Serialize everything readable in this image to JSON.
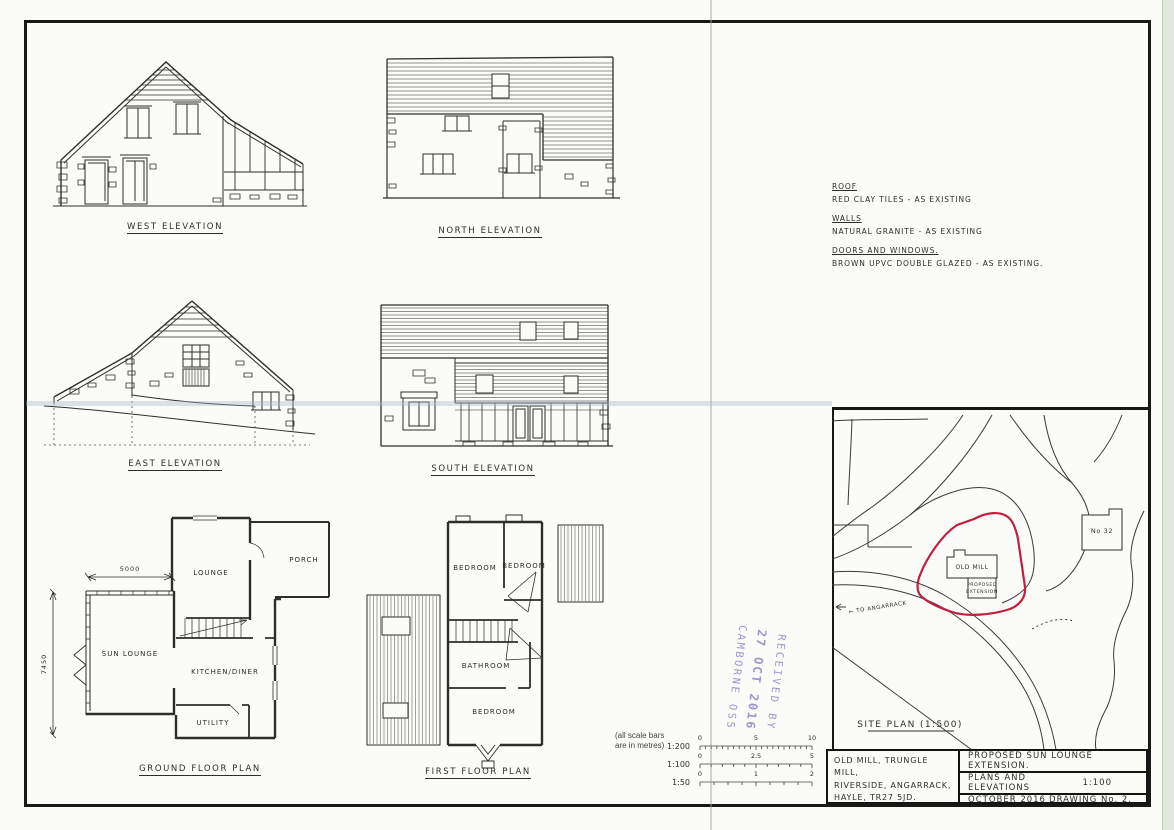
{
  "sheet": {
    "description": "Scanned architectural planning drawing",
    "colors": {
      "ink": "#2d2d2d",
      "site_outline": "#c11f3f",
      "stamp": "#8d86c7",
      "paper": "#fbfbf8"
    }
  },
  "elevations": {
    "west_label": "WEST ELEVATION",
    "north_label": "NORTH ELEVATION",
    "east_label": "EAST ELEVATION",
    "south_label": "SOUTH ELEVATION"
  },
  "plans": {
    "ground_title": "GROUND FLOOR PLAN",
    "first_title": "FIRST FLOOR PLAN",
    "ground_rooms": {
      "lounge": "LOUNGE",
      "porch": "PORCH",
      "sun_lounge": "SUN LOUNGE",
      "kitchen": "KITCHEN/DINER",
      "utility": "UTILITY"
    },
    "first_rooms": {
      "bedroom1": "BEDROOM",
      "bedroom2": "BEDROOM",
      "bathroom": "BATHROOM",
      "bedroom3": "BEDROOM"
    },
    "dimensions": {
      "sun_lounge_width": "5000",
      "sun_lounge_depth": "7450"
    }
  },
  "notes": {
    "roof_heading": "ROOF",
    "roof_text": "RED CLAY TILES  -  AS EXISTING",
    "walls_heading": "WALLS",
    "walls_text": "NATURAL GRANITE - AS EXISTING",
    "doors_heading": "DOORS AND WINDOWS.",
    "doors_text": "BROWN UPVC DOUBLE GLAZED - AS EXISTING."
  },
  "site_plan": {
    "title": "SITE PLAN (1:500)",
    "building_label": "OLD MILL",
    "extension_label_line1": "PROPOSED",
    "extension_label_line2": "EXTENSION",
    "neighbour_label": "No 32",
    "road_label": "← TO ANGARRACK"
  },
  "scale_bars": {
    "note_line1": "(all scale bars",
    "note_line2": "are in metres)",
    "bars": [
      {
        "ratio": "1:200",
        "start": "0",
        "mid": "5",
        "end": "10"
      },
      {
        "ratio": "1:100",
        "start": "0",
        "mid": "2.5",
        "end": "5"
      },
      {
        "ratio": "1:50",
        "start": "0",
        "mid": "1",
        "end": "2"
      }
    ]
  },
  "stamp": {
    "line1": "RECEIVED BY",
    "line2": "27 OCT 2016",
    "line3": "CAMBORNE  OSS"
  },
  "title_block": {
    "address_line1": "OLD MILL, TRUNGLE MILL,",
    "address_line2": "RIVERSIDE, ANGARRACK,",
    "address_line3": "HAYLE, TR27 5JD.",
    "project_title": "PROPOSED SUN LOUNGE EXTENSION.",
    "sheet_title": "PLANS AND ELEVATIONS",
    "scale": "1:100",
    "date": "OCTOBER 2016",
    "drawing_number": "DRAWING No. 2."
  }
}
